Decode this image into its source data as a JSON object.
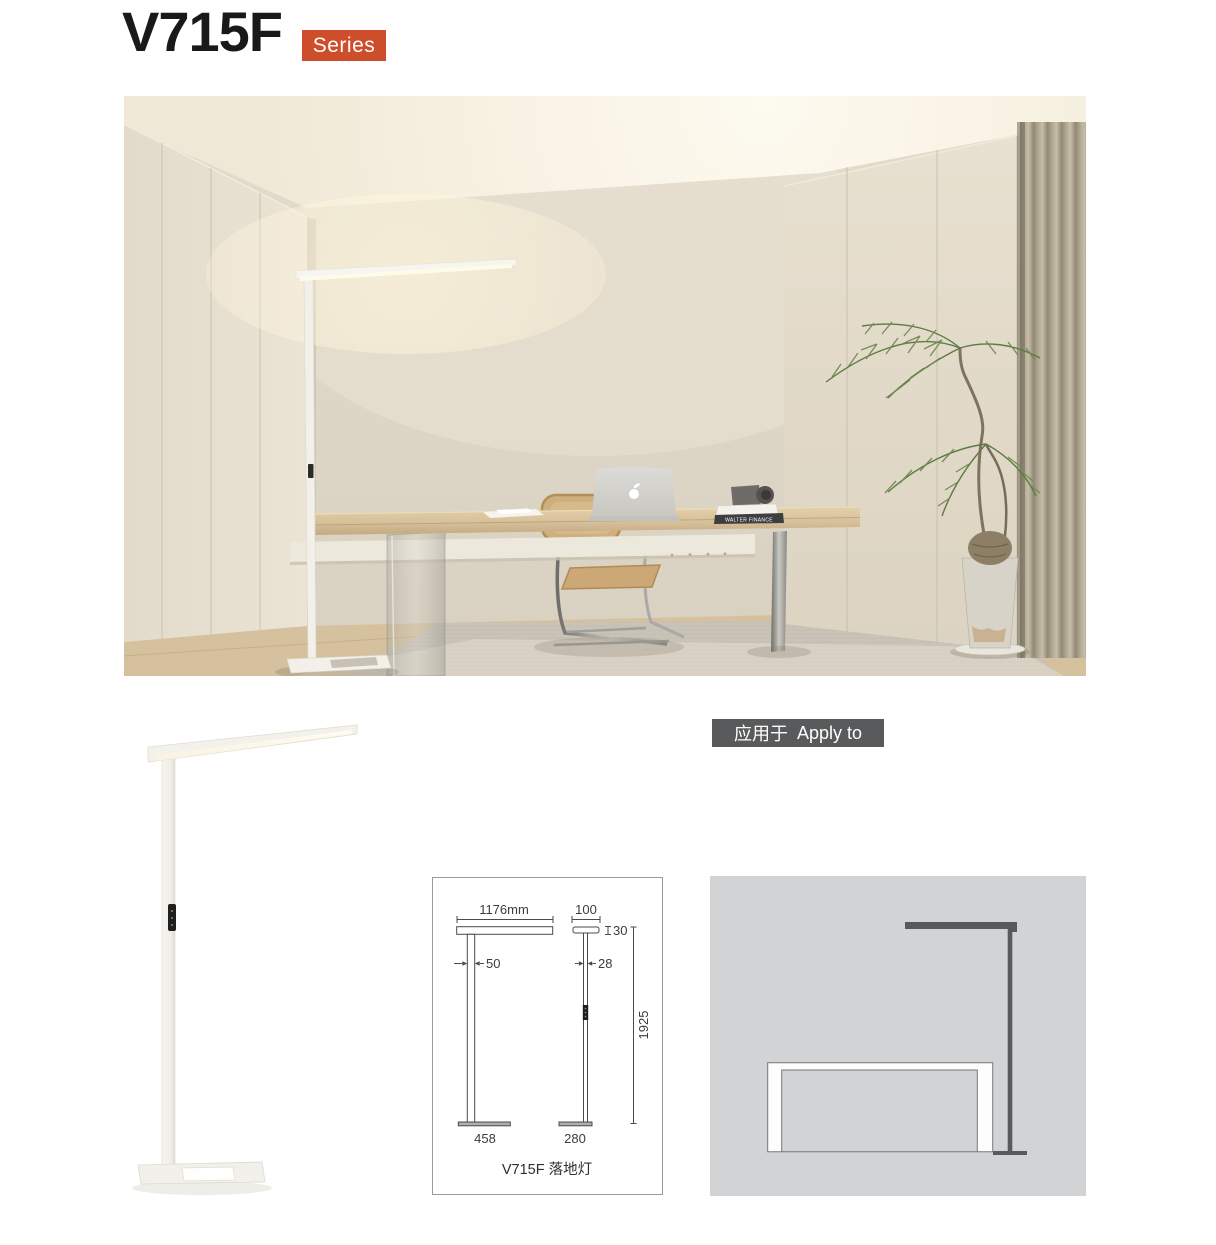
{
  "header": {
    "title": "V715F",
    "series_label": "Series"
  },
  "apply_badge": {
    "label_cn": "应用于",
    "label_en": "Apply to"
  },
  "spec_drawing": {
    "caption": "V715F 落地灯",
    "front_view": {
      "head_width": "1176mm",
      "pole_width": "50",
      "base_width": "458"
    },
    "side_view": {
      "head_depth": "100",
      "head_height": "30",
      "pole_depth": "28",
      "total_height": "1925",
      "base_depth": "280"
    }
  },
  "photo": {
    "book_spine_text": "WALTER FINANCE"
  },
  "colors": {
    "accent_orange": "#CE4D2A",
    "badge_gray": "#595A5B",
    "diagram_background": "#D2D3D4",
    "diagram_lamp": "#58595B",
    "drawing_line": "#4A4A4B"
  }
}
